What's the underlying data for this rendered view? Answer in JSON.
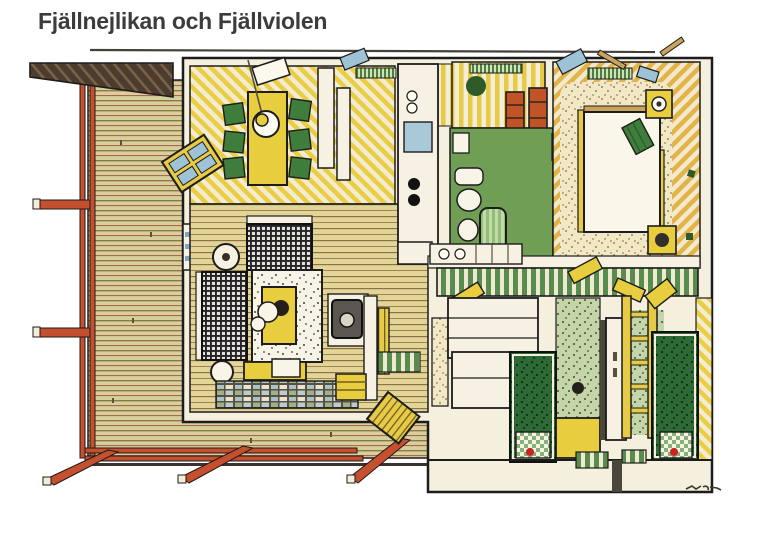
{
  "header": {
    "title": "Fjällnejlikan och Fjällviolen",
    "title_color": "#3c3c3c"
  },
  "illustration": {
    "kind": "hand-drawn cutaway floor plan of a small house with furnished rooms and wrap-around wooden deck",
    "rooms": [
      "deck-terrace",
      "dining-room",
      "kitchen",
      "sauna-utility",
      "bathroom",
      "master-bedroom",
      "hallway",
      "living-room",
      "kids-room-1",
      "kids-room-2"
    ],
    "palette": {
      "paper": "#ffffff",
      "ink": "#1c1c1c",
      "deck_wood": "#d9cf9c",
      "floor_wood": "#e3d598",
      "wall_cream": "#f5efdd",
      "stripe_yellow": "#e9ce44",
      "railing_red": "#c4502f",
      "furniture_yellow": "#e8ce3e",
      "furniture_green": "#3f7d3c",
      "bath_green": "#6f9e54",
      "appliance_red": "#c05427",
      "glass_blue": "#9fc3d6",
      "roof_brown": "#4c3c2d",
      "bed_dark_green": "#2d6a36",
      "rug_cream": "#f1e8c6",
      "rug_sage": "#c5d5a9",
      "tv_gray": "#5a5750",
      "mesh_dark": "#23232b"
    }
  }
}
